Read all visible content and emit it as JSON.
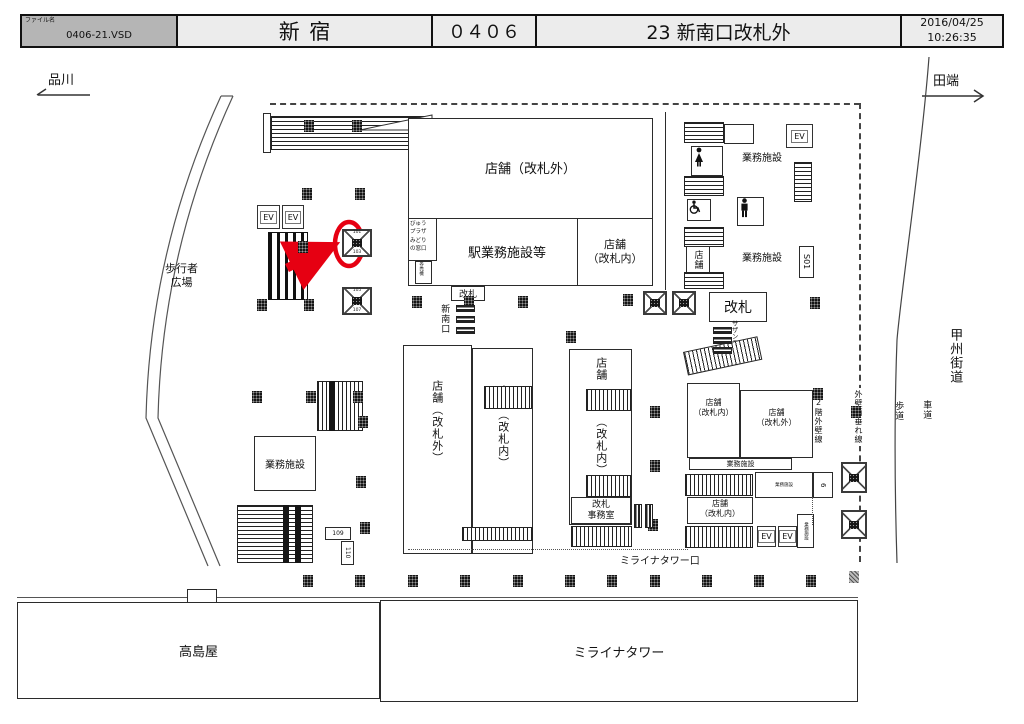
{
  "header": {
    "file_label": "ファイル名",
    "file_value": "0406-21.VSD",
    "station": "新宿",
    "code": "０４０６",
    "title": "23 新南口改札外",
    "date": "2016/04/25",
    "time": "10:26:35"
  },
  "directions": {
    "left": "品川",
    "right": "田端"
  },
  "roads": {
    "koshu_kaido": "甲州街道",
    "sidewalk": "歩道",
    "roadway": "車道",
    "wall_drip_line": "外壁雨垂れ線",
    "wall_2f_line": "2階外壁線"
  },
  "labels": {
    "plaza": "歩行者\n広場",
    "shop_outside": "店舗（改札外）",
    "station_ops": "駅業務施設等",
    "view_plaza": "びゅう\nプラザ\nみどり\nの窓口",
    "ticket_machine": "券売機",
    "shop_inside_2l": "店舗\n（改札内）",
    "shop_outside_2l": "店舗\n（改札外）",
    "gate": "改札",
    "new_south_gate": "新南口",
    "southern_terrace_exit": "サザンテラス口",
    "office": "業務施設",
    "ev": "EV",
    "s01": "S01",
    "shop": "店舗",
    "inside_gate_v": "（改札内）",
    "shop_outside_v": "店舗（改札外）",
    "shop_inside_v": "店舗（改札内）",
    "gate_office": "改札\n事務室",
    "miraina_exit": "ミライナタワー口",
    "takashimaya": "高島屋",
    "miraina_tower": "ミライナタワー",
    "n109": "109",
    "n110": "110",
    "n6": "6",
    "p101": "101",
    "p103": "103",
    "p105": "105",
    "p107": "107"
  },
  "colors": {
    "accent_red": "#e60012",
    "header_gray": "#b5b5b5",
    "panel_gray": "#ececec",
    "line": "#2b2b2b"
  }
}
